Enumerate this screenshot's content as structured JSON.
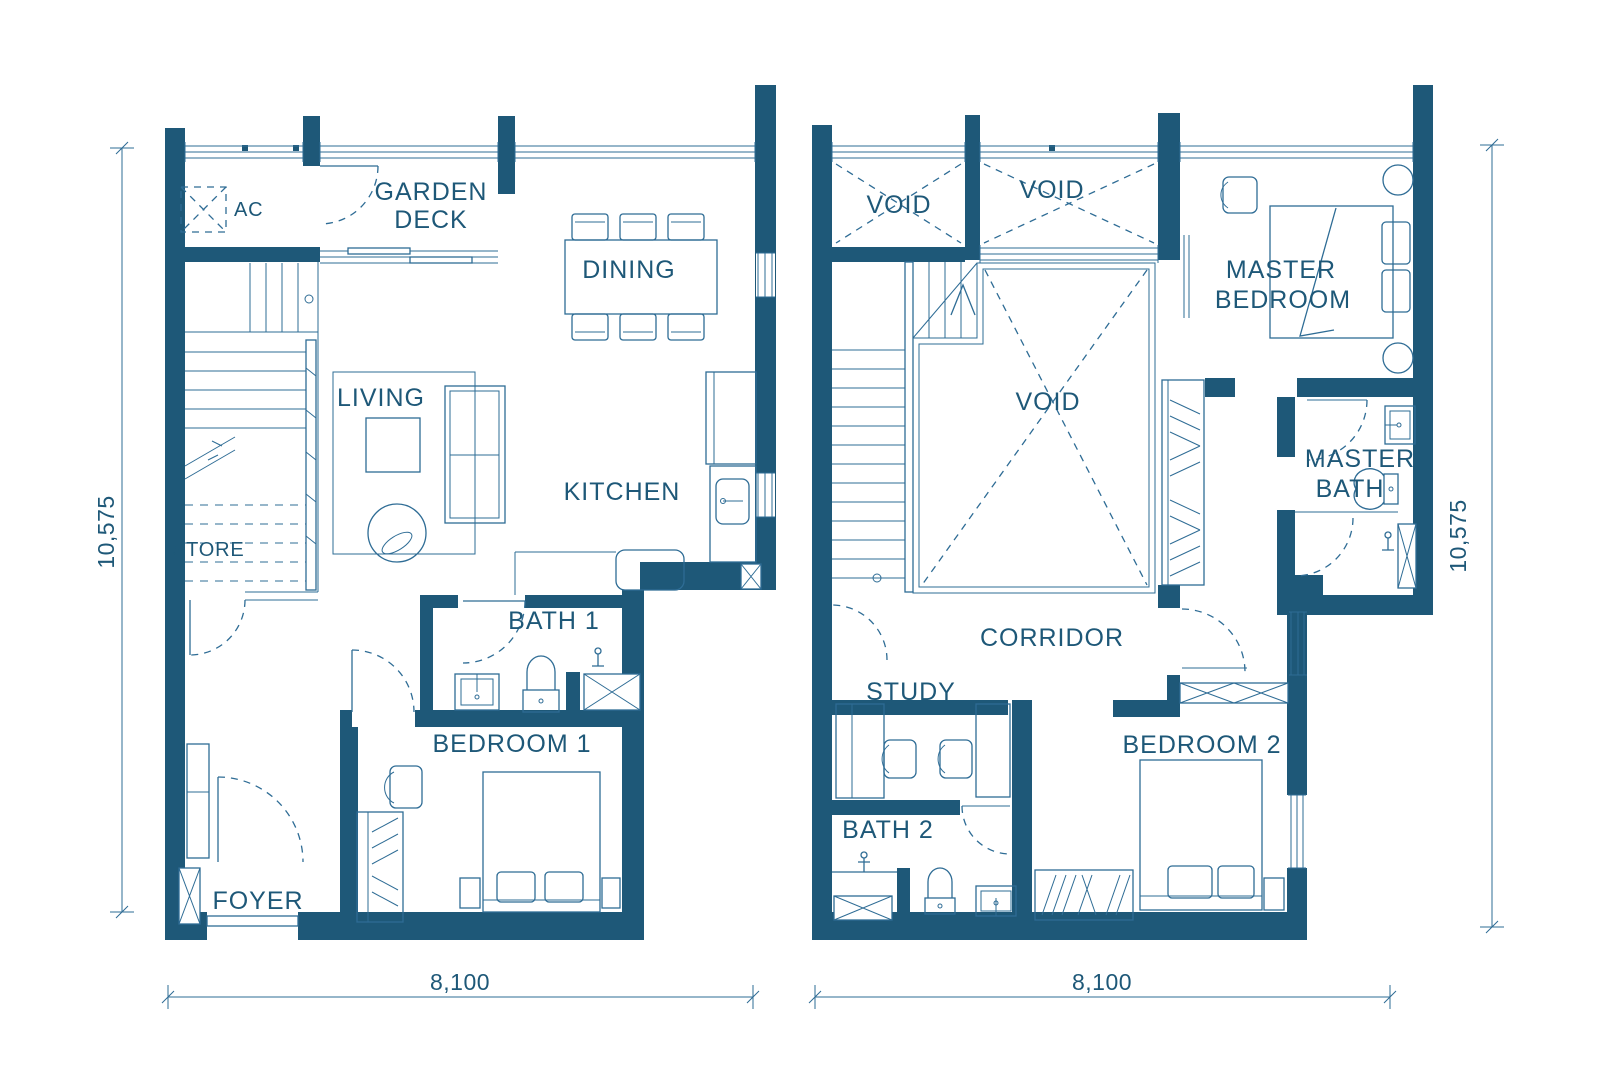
{
  "colors": {
    "background": "#ffffff",
    "wall": "#1e5878",
    "line": "#2e6c95",
    "text": "#1e5878"
  },
  "lower_floor": {
    "rooms": {
      "ac": "AC",
      "garden_deck_line1": "GARDEN",
      "garden_deck_line2": "DECK",
      "dining": "DINING",
      "living": "LIVING",
      "kitchen": "KITCHEN",
      "store": "STORE",
      "bath_1": "BATH 1",
      "bedroom_1": "BEDROOM 1",
      "foyer": "FOYER"
    },
    "dimensions": {
      "height": "10,575",
      "width": "8,100"
    }
  },
  "upper_floor": {
    "rooms": {
      "void_top_left": "VOID",
      "void_top_middle": "VOID",
      "void_center": "VOID",
      "master_bedroom_line1": "MASTER",
      "master_bedroom_line2": "BEDROOM",
      "master_bath_line1": "MASTER",
      "master_bath_line2": "BATH",
      "corridor": "CORRIDOR",
      "study": "STUDY",
      "bath_2": "BATH 2",
      "bedroom_2": "BEDROOM 2"
    },
    "dimensions": {
      "height": "10,575",
      "width": "8,100"
    }
  }
}
